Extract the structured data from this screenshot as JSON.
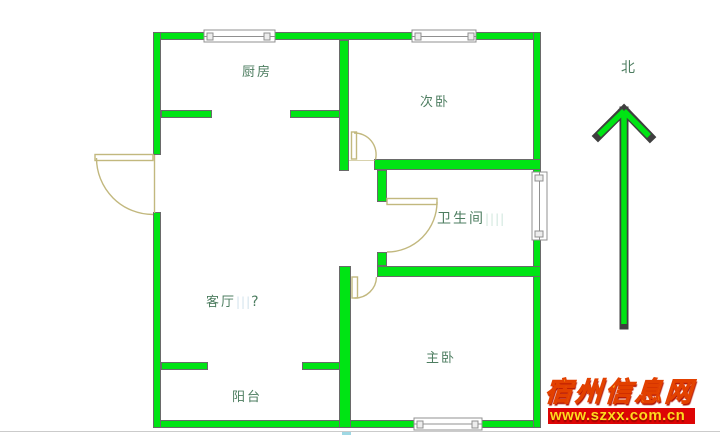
{
  "plan": {
    "rooms": [
      {
        "id": "kitchen",
        "label": "厨房"
      },
      {
        "id": "bedroom2",
        "label": "次卧"
      },
      {
        "id": "bathroom",
        "label": "卫生间",
        "marks": "||||"
      },
      {
        "id": "living",
        "label": "客厅",
        "marks": "|||",
        "suffix": "?"
      },
      {
        "id": "balcony",
        "label": "阳台"
      },
      {
        "id": "master",
        "label": "主卧"
      }
    ],
    "compass_label": "北"
  },
  "watermark": {
    "site_name": "宿州信息网",
    "url": "www.szxx.com.cn"
  },
  "colors": {
    "wall": "#00e414",
    "door": "#c2b87e",
    "label": "#4d7d60",
    "watermark_gold": "#ffc326",
    "watermark_red": "#dd0505"
  }
}
